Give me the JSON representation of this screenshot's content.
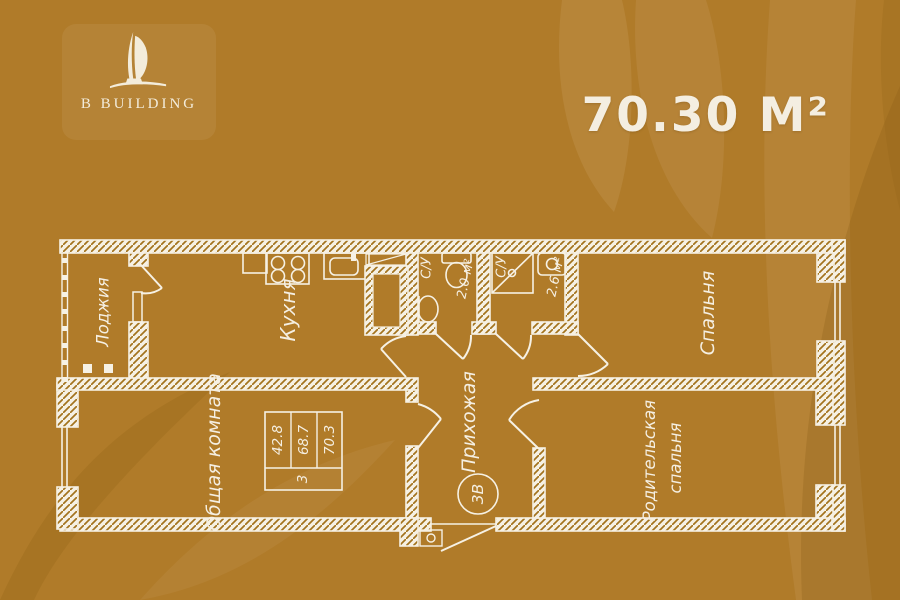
{
  "brand": {
    "logo_text": "B BUILDING"
  },
  "header": {
    "total_area": "70.30 М²"
  },
  "plan": {
    "rooms": {
      "loggia": {
        "label": "Лоджия"
      },
      "kitchen": {
        "label": "Кухня"
      },
      "bathroom1": {
        "label": "С/У",
        "area": "2.0 м²"
      },
      "bathroom2": {
        "label": "С/У",
        "area": "2.6 м²"
      },
      "bedroom": {
        "label": "Спальня"
      },
      "living_room": {
        "label": "Общая комната"
      },
      "hallway": {
        "label": "Прихожая"
      },
      "parents_bedroom": {
        "label_line1": "Родительская",
        "label_line2": "спальня"
      }
    },
    "stamp": {
      "values": [
        "42.8",
        "68.7",
        "70.3"
      ],
      "rooms_count": "3"
    },
    "unit_badge": "3В"
  },
  "colors": {
    "background": "#b07b29",
    "line_white": "#f6f1e4",
    "hatch_brown": "#a3731d",
    "decor_light": "#c69a5e",
    "decor_dark": "#8a5f15"
  }
}
